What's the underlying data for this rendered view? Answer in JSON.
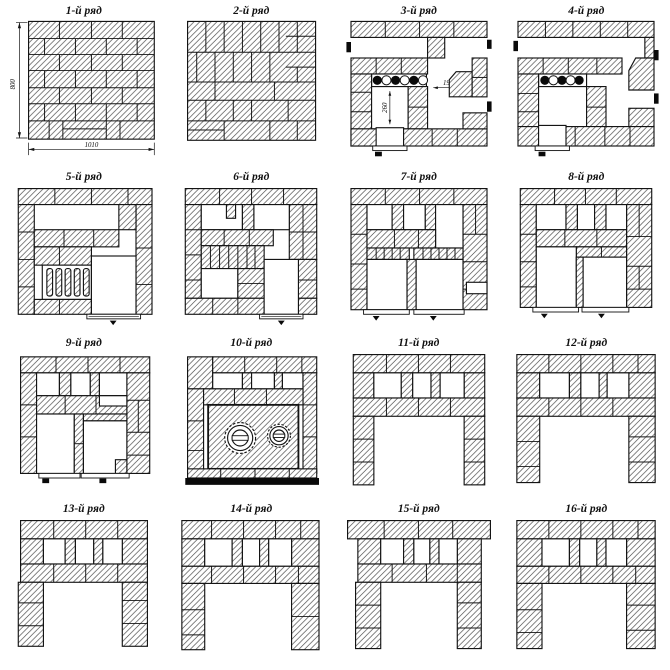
{
  "colors": {
    "ink": "#141414",
    "paper": "#ffffff"
  },
  "panels": [
    {
      "title": "1-й ряд",
      "height_dim": "800",
      "width_dim": "1010"
    },
    {
      "title": "2-й ряд"
    },
    {
      "title": "3-й ряд",
      "opening_dim": "190",
      "pit_dim": "260"
    },
    {
      "title": "4-й ряд"
    },
    {
      "title": "5-й ряд"
    },
    {
      "title": "6-й ряд"
    },
    {
      "title": "7-й ряд"
    },
    {
      "title": "8-й ряд"
    },
    {
      "title": "9-й ряд"
    },
    {
      "title": "10-й ряд"
    },
    {
      "title": "11-й ряд"
    },
    {
      "title": "12-й ряд"
    },
    {
      "title": "13-й ряд"
    },
    {
      "title": "14-й ряд"
    },
    {
      "title": "15-й ряд"
    },
    {
      "title": "16-й ряд"
    }
  ]
}
